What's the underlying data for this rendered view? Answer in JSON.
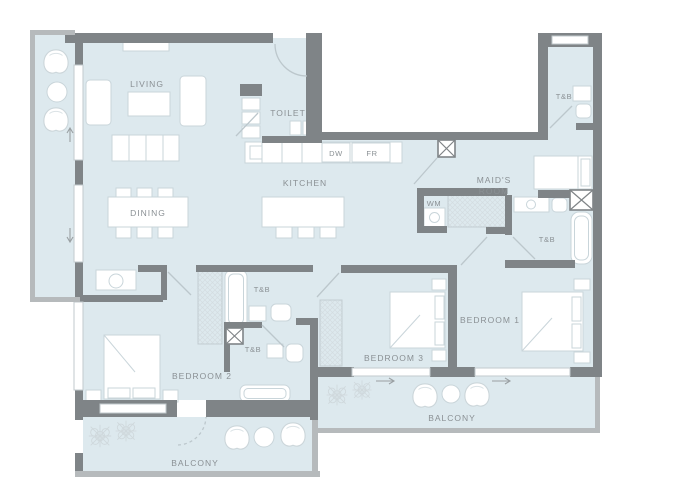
{
  "plan": {
    "type": "apartment-floor-plan",
    "labels": {
      "living": "LIVING",
      "dining": "DINING",
      "kitchen": "KITCHEN",
      "toilet": "TOILET",
      "maids1": "MAID'S",
      "maids2": "ROOM",
      "bedroom1": "BEDROOM 1",
      "bedroom2": "BEDROOM 2",
      "bedroom3": "BEDROOM 3",
      "balcony_left": "BALCONY",
      "balcony_right": "BALCONY",
      "tnb_maid": "T&B",
      "tnb_master": "T&B",
      "tnb_upper": "T&B",
      "tnb_lower": "T&B",
      "dw": "DW",
      "fr": "FR",
      "wm": "WM"
    },
    "colors": {
      "floor": "#dde9ee",
      "wall": "#7f8487",
      "parapet": "#b6babc",
      "furniture_line": "#c9d5da",
      "label_text": "#8a9094"
    }
  }
}
